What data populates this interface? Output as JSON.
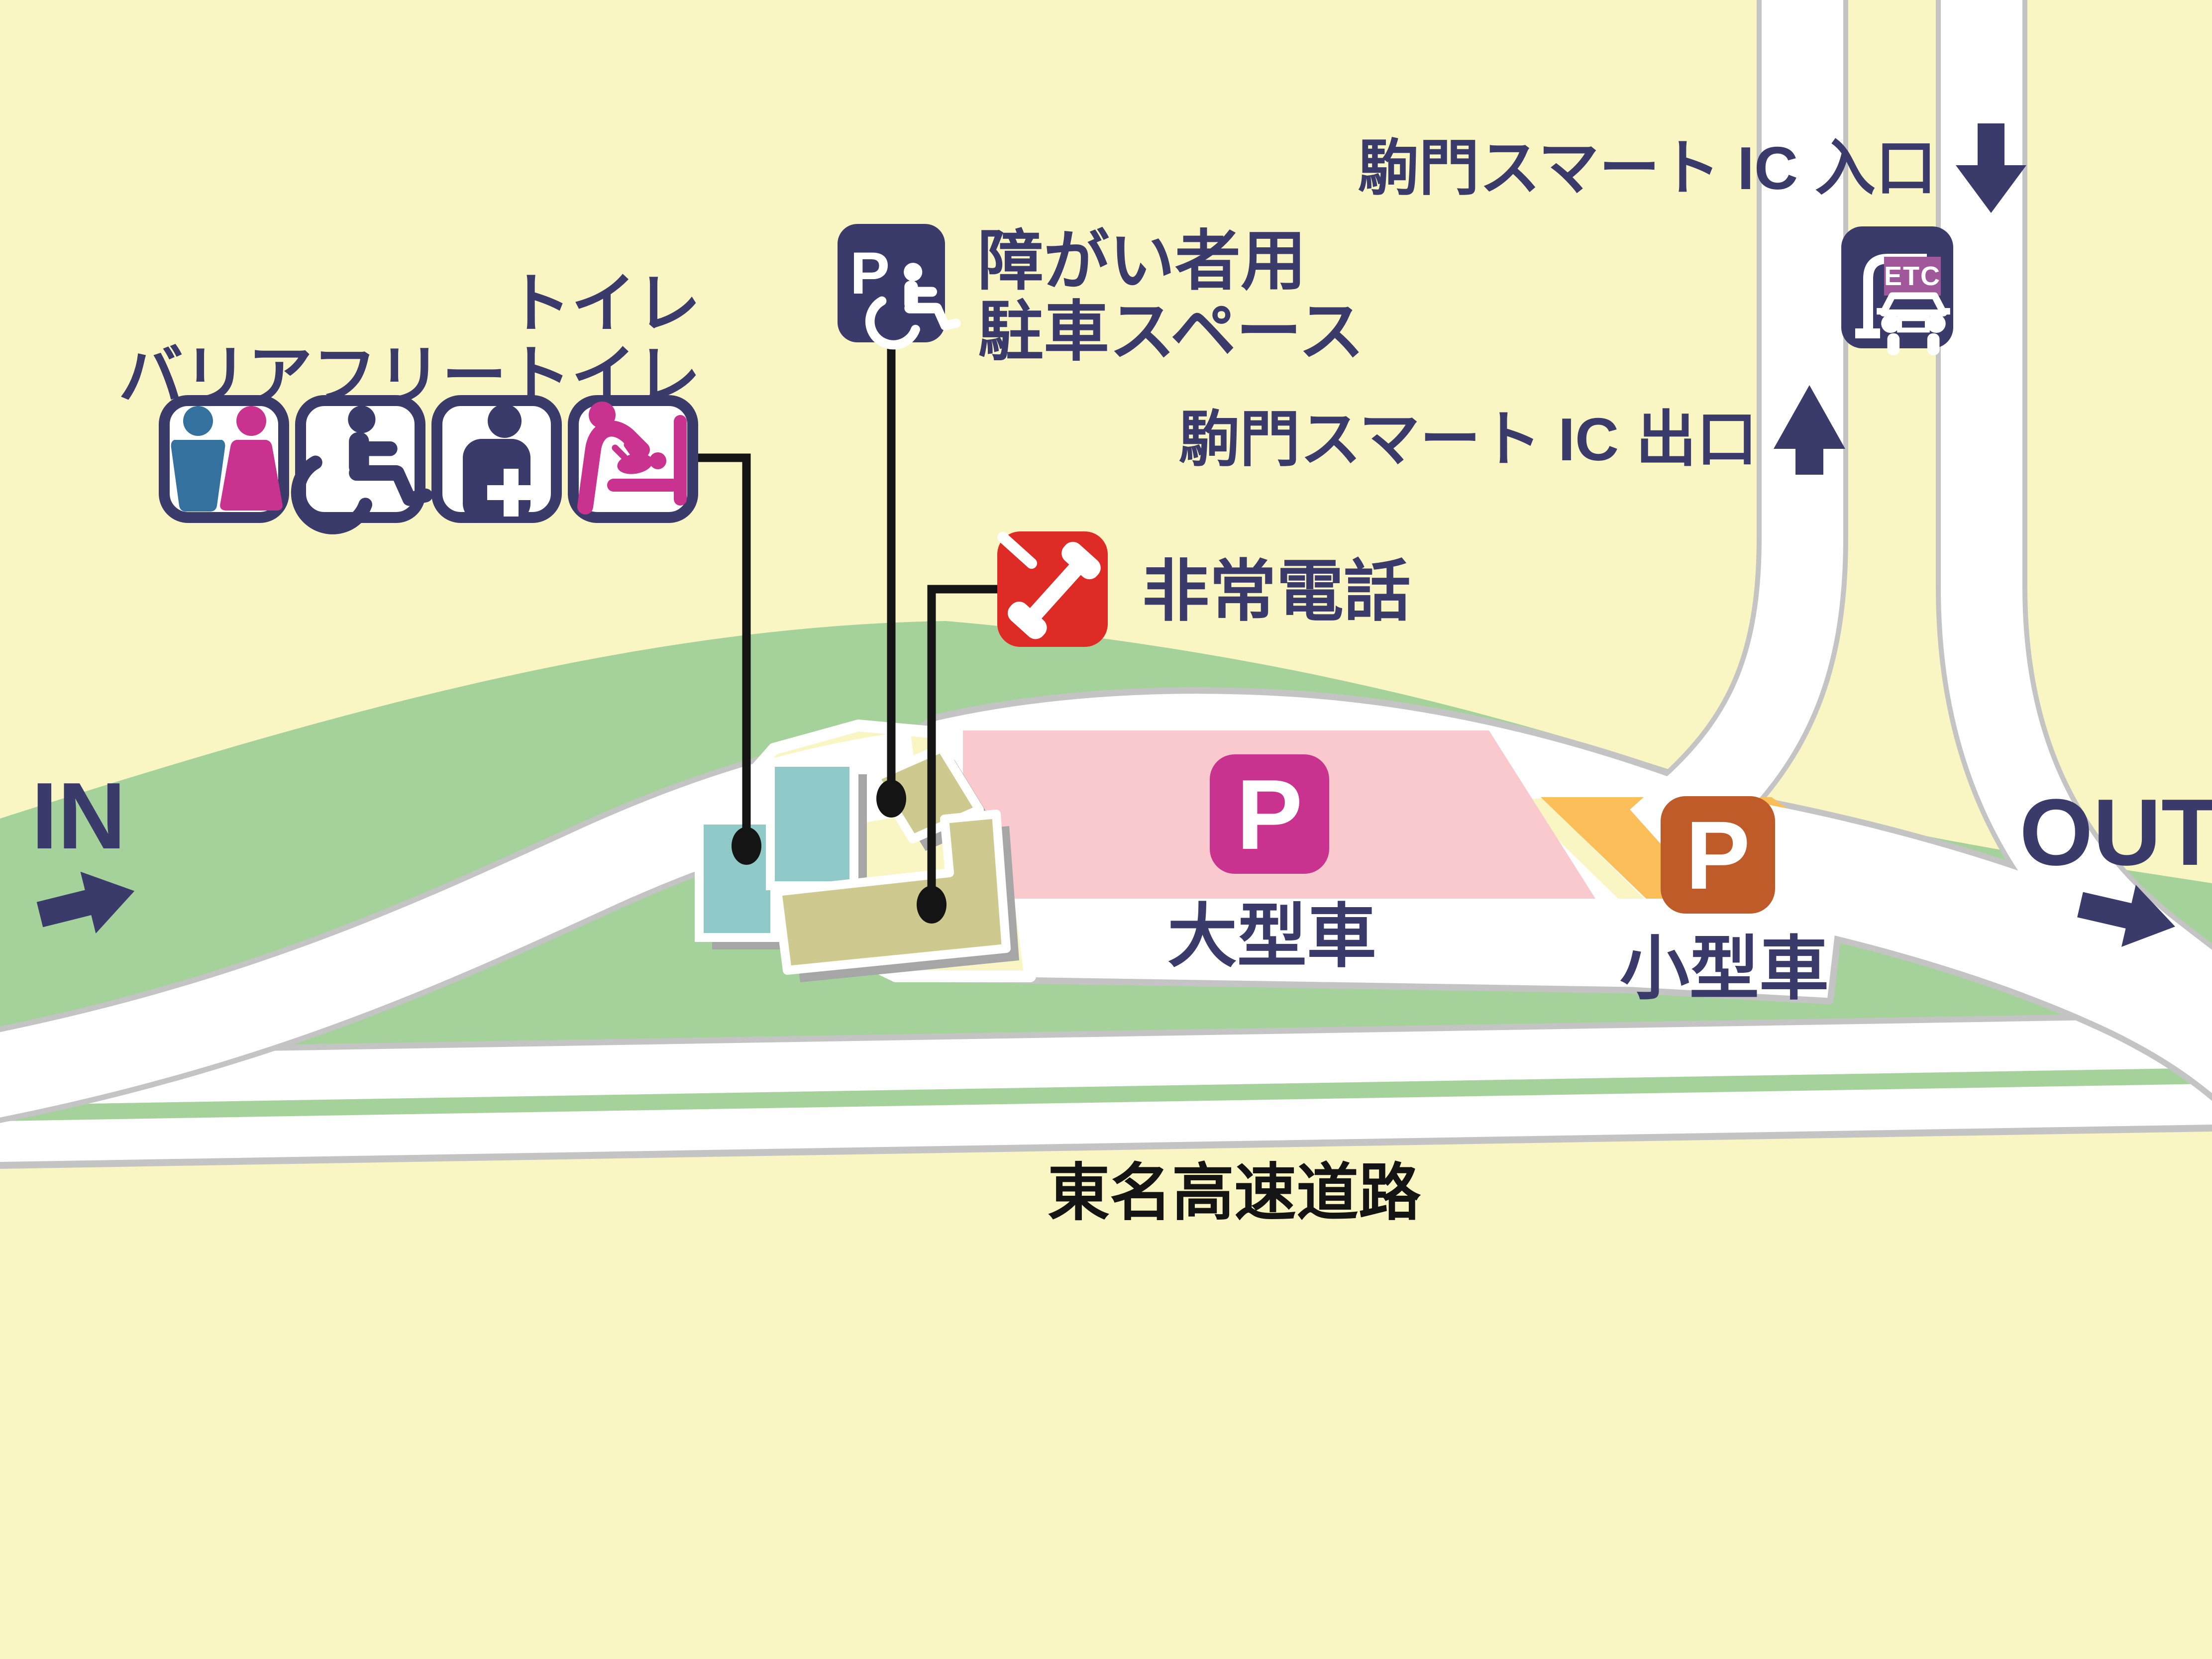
{
  "map": {
    "labels": {
      "in": "IN",
      "out": "OUT",
      "highway": "東名高速道路",
      "large_vehicle": "大型車",
      "small_vehicle": "小型車",
      "p": "P",
      "etc": "ETC",
      "ic_entrance": "駒門スマート IC 入口",
      "ic_exit": "駒門スマート IC 出口",
      "toilet": "トイレ",
      "barrier_free_toilet": "バリアフリートイレ",
      "disabled_parking_line1": "障がい者用",
      "disabled_parking_line2": "駐車スペース",
      "emergency_phone": "非常電話"
    },
    "icons": {
      "restroom": "male-female-restroom-icon",
      "accessible_toilet": "wheelchair-icon",
      "ostomate": "person-with-cross-icon",
      "baby_changing": "baby-changing-icon",
      "accessible_parking": "p-wheelchair-sign-icon",
      "emergency_phone": "red-phone-icon",
      "etc_gate": "etc-gate-car-icon",
      "ic_entrance_arrow": "down-arrow-icon",
      "ic_exit_arrow": "up-arrow-icon",
      "in_arrow": "right-arrow-icon",
      "out_arrow": "right-arrow-icon"
    },
    "colors": {
      "background": "#F9F6C4",
      "green": "#A5D29B",
      "road_white": "#FFFFFF",
      "road_casing": "#C4C4C4",
      "navy": "#3A3A6B",
      "pink_parking": "#FAC9CD",
      "orange_parking": "#FBBE59",
      "orange_p": "#BF5B28",
      "magenta": "#C9338F",
      "male_blue": "#34719E",
      "red": "#DF2B26",
      "etc_purple": "#A1589B",
      "teal_building": "#90CAC8",
      "khaki_building": "#CECA8F",
      "shadow": "#A6A6A6",
      "black": "#141414"
    }
  }
}
